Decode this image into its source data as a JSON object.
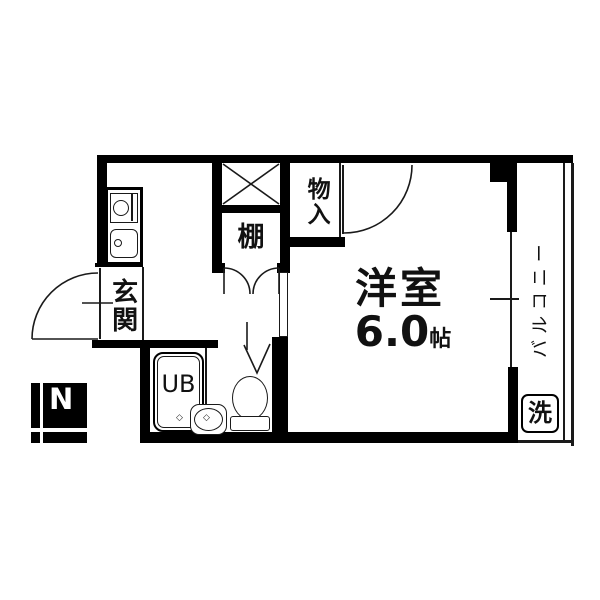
{
  "floor_plan": {
    "room": {
      "name": "洋室",
      "size_value": "6.0",
      "size_unit": "帖"
    },
    "labels": {
      "entrance": "玄関",
      "storage": "物入",
      "shelf": "棚",
      "unit_bath": "UB",
      "wash": "洗",
      "balcony": "バルコニー",
      "compass": "N"
    },
    "marks": {
      "diamond": "◇"
    },
    "colors": {
      "wall": "#000000",
      "background": "#ffffff",
      "line": "#1a1a1a"
    }
  }
}
